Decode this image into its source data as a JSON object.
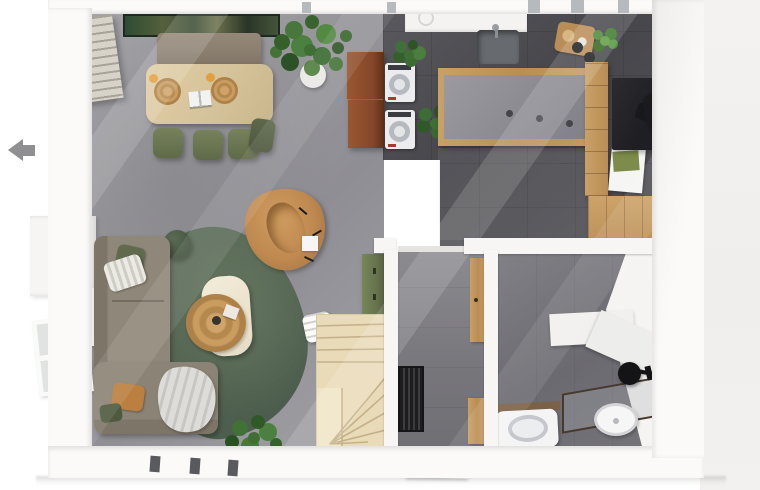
{
  "meta": {
    "type": "3d-floorplan-render",
    "view": "top-down",
    "level": "ground-floor"
  },
  "nav": {
    "back_arrow": "previous"
  },
  "rooms": {
    "living": "living room",
    "dining": "dining area",
    "kitchen": "kitchen",
    "utility": "utility corner",
    "hallway": "entrance hall",
    "staircase": "winder staircase",
    "bathroom": "shower room"
  },
  "objects": {
    "wall_art": "panoramic landscape artwork",
    "dining_bench": "upholstered dining bench",
    "dining_table": "oak dining table",
    "dining_chairs": "green dining chairs",
    "placemats": "round jute placemats",
    "magazine": "open magazine",
    "shutters": "louvered window shutter",
    "tall_window": "tall side window",
    "curtain_rod": "black curtain rail",
    "monstera": "large potted plant",
    "utility_doors": "open cabinet doors",
    "washer": "washing machine",
    "dryer": "tumble dryer",
    "kitchen_sink": "undermount sink",
    "cutting_board": "wooden serving board",
    "jars": "black storage jars",
    "island": "kitchen island",
    "oak_cabinets": "oak cabinet run",
    "desk": "black desk",
    "desk_chair": "black chair",
    "laptop": "laptop with notebook",
    "sofa": "corner sofa",
    "rug": "green wool rug",
    "coffee_table": "cream coffee table",
    "jute_tray": "round rattan tray",
    "armchair": "caramel lounge chair",
    "side_table": "green side table",
    "basket_table": "side table with baskets",
    "blanket": "throw blanket",
    "floor_plant": "potted plant",
    "green_cabinet": "olive storage cabinet",
    "white_stool": "small white chair",
    "stairs": "timber winder stairs",
    "doormat": "slatted entrance mat",
    "entrance_door": "front door",
    "bath_doors": "oak bathroom doors",
    "toilet": "wall-hung toilet",
    "vanity": "glass vanity with basin",
    "shower_head": "black rain shower",
    "window_low": "lower-left window"
  },
  "palette": {
    "floor_living": "#97969b",
    "floor_kitchen": "#4b4a4f",
    "floor_hall": "#7b7a7f",
    "floor_bath": "#6f6e73",
    "wall": "#fbfaf8",
    "exterior": "#f1efed",
    "rug_green": "#5a6b59",
    "sofa_taupe": "#8e8577",
    "armchair_caramel": "#bf8950",
    "oak_light": "#dcc89e",
    "oak_mid": "#c49a62",
    "chair_green": "#6f7a55",
    "cabinet_olive": "#6e7b53",
    "rust_door": "#8a4c2b",
    "stair_wood": "#e9dab8",
    "black_fixture": "#1b1b1e",
    "art_green": "#2f4b33",
    "arrow_gray": "#8f8f91",
    "jute_tan": "#c49a5c"
  }
}
